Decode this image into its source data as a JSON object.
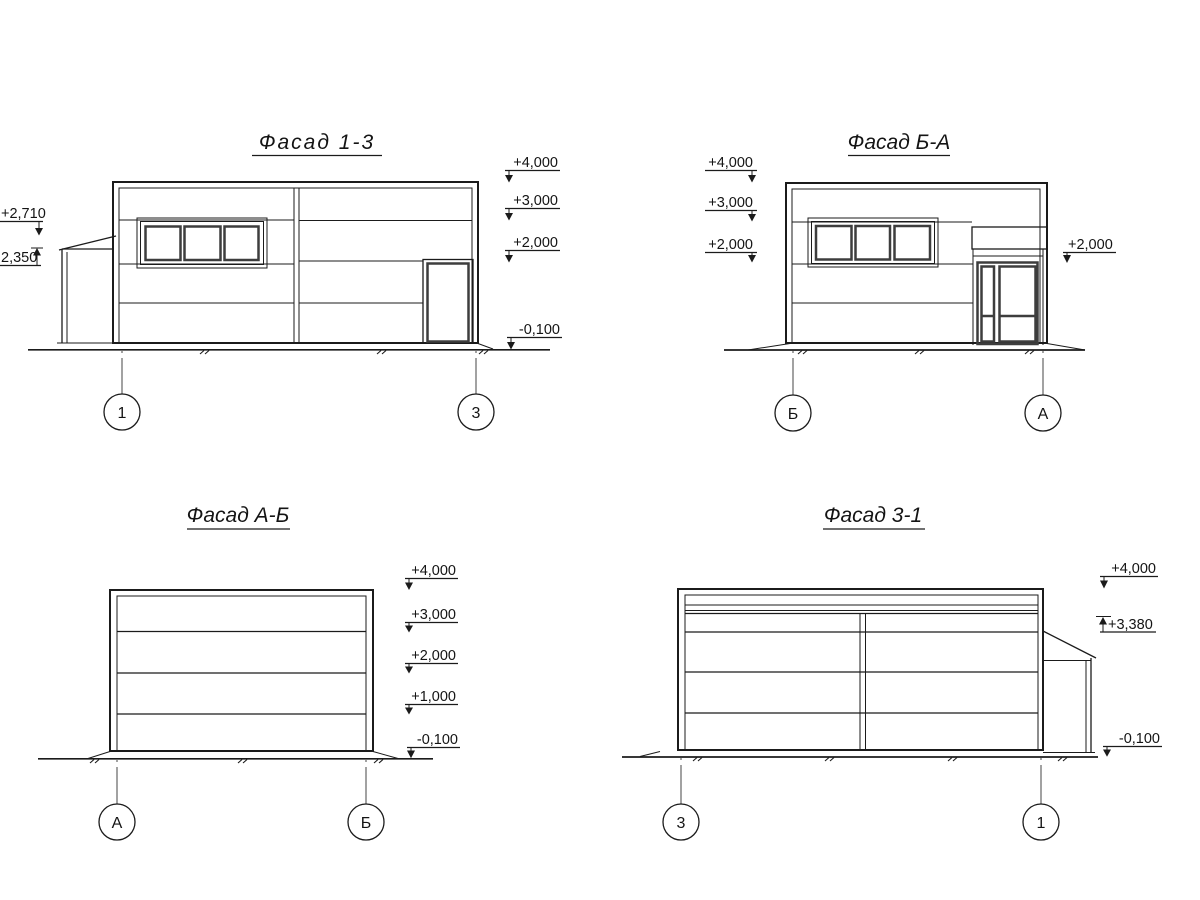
{
  "sheet": {
    "colors": {
      "line": "#1b1b1b",
      "frame": "#3d3d3d",
      "background": "#ffffff"
    },
    "f13": {
      "title": "Фасад 1-3",
      "m4000": "+4,000",
      "m3000": "+3,000",
      "m2000": "+2,000",
      "m0100": "-0,100",
      "m2710": "+2,710",
      "m2350": "2,350",
      "axisL": "1",
      "axisR": "3"
    },
    "fba": {
      "title": "Фасад Б-А",
      "m4000": "+4,000",
      "m3000": "+3,000",
      "m2000": "+2,000",
      "m2000r": "+2,000",
      "axisL": "Б",
      "axisR": "А"
    },
    "fab": {
      "title": "Фасад А-Б",
      "m4000": "+4,000",
      "m3000": "+3,000",
      "m2000": "+2,000",
      "m1000": "+1,000",
      "m0100": "-0,100",
      "axisL": "А",
      "axisR": "Б"
    },
    "f31": {
      "title": "Фасад 3-1",
      "m4000": "+4,000",
      "m3380": "+3,380",
      "m0100": "-0,100",
      "axisL": "3",
      "axisR": "1"
    }
  }
}
